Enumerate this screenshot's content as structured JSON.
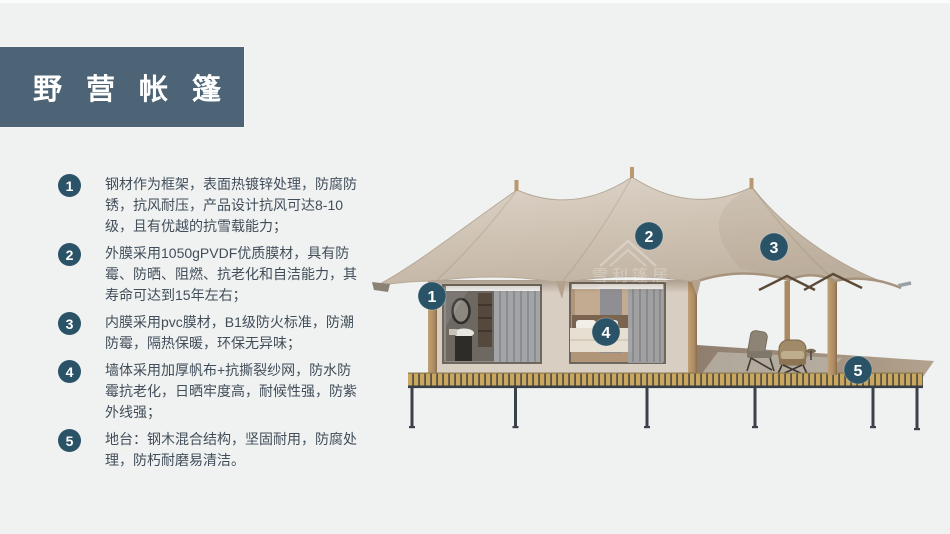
{
  "title": "野营帐篷",
  "colors": {
    "bg": "#f0f1f1",
    "title_bg": "#4d6477",
    "accent": "#2b5367",
    "text": "#414e5a",
    "roof_light": "#ded5ca",
    "roof_dark": "#c2b4a3",
    "wood": "#b2906a",
    "deck_plank": "#c9a75f",
    "steel": "#3a4149"
  },
  "features": [
    {
      "number": "1",
      "text": "钢材作为框架，表面热镀锌处理，防腐防锈，抗风耐压，产品设计抗风可达8-10级，且有优越的抗雪载能力；"
    },
    {
      "number": "2",
      "text": "外膜采用1050gPVDF优质膜材，具有防霉、防晒、阻燃、抗老化和自洁能力，其寿命可达到15年左右；"
    },
    {
      "number": "3",
      "text": "内膜采用pvc膜材，B1级防火标准，防潮防霉，隔热保暖，环保无异味；"
    },
    {
      "number": "4",
      "text": "墙体采用加厚帆布+抗撕裂纱网，防水防霉抗老化，日晒牢度高，耐候性强，防紫外线强；"
    },
    {
      "number": "5",
      "text": "地台：钢木混合结构，坚固耐用，防腐处理，防朽耐磨易清洁。"
    }
  ],
  "figure": {
    "watermark": "雪利篷居",
    "badges": [
      {
        "number": "1"
      },
      {
        "number": "2"
      },
      {
        "number": "3"
      },
      {
        "number": "4"
      },
      {
        "number": "5"
      }
    ]
  }
}
